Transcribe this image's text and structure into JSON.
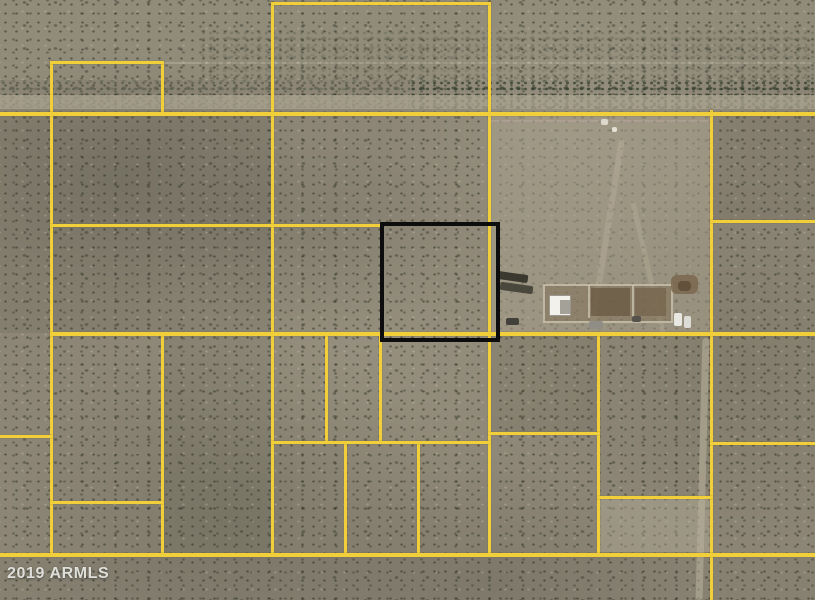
{
  "map": {
    "width": 815,
    "height": 600,
    "watermark": "2019 ARMLS",
    "colors": {
      "boundary_yellow": "#f0cf3a",
      "highlight_black": "#0d0d0d",
      "terrain_base": "#8d8676",
      "road_band": "#aaa28c",
      "yard_light": "#a69f8b",
      "vegetation_dark": "#2f4231"
    },
    "highlight_parcel": {
      "name": "highlighted-parcel-outline",
      "x": 380,
      "y": 222,
      "w": 112,
      "h": 112,
      "stroke": 4
    },
    "boundary_lines": {
      "vertical": [
        {
          "x": 50,
          "y1": 61,
          "y2": 554
        },
        {
          "x": 161,
          "y1": 61,
          "y2": 114
        },
        {
          "x": 161,
          "y1": 332,
          "y2": 554
        },
        {
          "x": 271,
          "y1": 2,
          "y2": 554
        },
        {
          "x": 488,
          "y1": 2,
          "y2": 554
        },
        {
          "x": 325,
          "y1": 332,
          "y2": 443
        },
        {
          "x": 379,
          "y1": 333,
          "y2": 443
        },
        {
          "x": 344,
          "y1": 441,
          "y2": 554
        },
        {
          "x": 417,
          "y1": 441,
          "y2": 554
        },
        {
          "x": 597,
          "y1": 332,
          "y2": 554
        },
        {
          "x": 710,
          "y1": 110,
          "y2": 600
        }
      ],
      "horizontal": [
        {
          "y": 2,
          "x1": 271,
          "x2": 491,
          "t": 3
        },
        {
          "y": 61,
          "x1": 50,
          "x2": 164,
          "t": 3
        },
        {
          "y": 112,
          "x1": 0,
          "x2": 815,
          "t": 4
        },
        {
          "y": 224,
          "x1": 50,
          "x2": 384,
          "t": 3
        },
        {
          "y": 332,
          "x1": 50,
          "x2": 815,
          "t": 4
        },
        {
          "y": 435,
          "x1": 0,
          "x2": 53,
          "t": 3
        },
        {
          "y": 441,
          "x1": 271,
          "x2": 491,
          "t": 3
        },
        {
          "y": 432,
          "x1": 488,
          "x2": 600,
          "t": 3
        },
        {
          "y": 496,
          "x1": 597,
          "x2": 713,
          "t": 3
        },
        {
          "y": 501,
          "x1": 50,
          "x2": 164,
          "t": 3
        },
        {
          "y": 220,
          "x1": 710,
          "x2": 815,
          "t": 3
        },
        {
          "y": 442,
          "x1": 710,
          "x2": 815,
          "t": 3
        },
        {
          "y": 553,
          "x1": 0,
          "x2": 815,
          "t": 4
        }
      ]
    },
    "terrain_underlays": [
      {
        "name": "terrain-top-band",
        "x": 0,
        "y": 0,
        "w": 815,
        "h": 80,
        "fill": "rgba(150,144,126,0.55)"
      },
      {
        "name": "terrain-left-dark",
        "x": 0,
        "y": 114,
        "w": 273,
        "h": 219,
        "fill": "rgba(55,58,45,0.10)"
      },
      {
        "name": "terrain-right-top-dark",
        "x": 710,
        "y": 114,
        "w": 105,
        "h": 107,
        "fill": "rgba(55,58,45,0.09)"
      },
      {
        "name": "terrain-midleft-dark",
        "x": 163,
        "y": 333,
        "w": 110,
        "h": 220,
        "fill": "rgba(55,58,45,0.08)"
      },
      {
        "name": "terrain-bottom-strip",
        "x": 0,
        "y": 554,
        "w": 815,
        "h": 46,
        "fill": "rgba(55,58,45,0.06)"
      },
      {
        "name": "terrain-center-green",
        "x": 489,
        "y": 333,
        "w": 109,
        "h": 99,
        "fill": "rgba(45,60,35,0.09)"
      }
    ],
    "terrain_overlays": [
      {
        "name": "road-band",
        "x": 0,
        "y": 95,
        "w": 815,
        "h": 14,
        "fill": "rgba(172,165,144,0.72)"
      },
      {
        "name": "yard-smooth",
        "x": 490,
        "y": 114,
        "w": 221,
        "h": 219,
        "fill": "rgba(168,161,140,0.52)",
        "radius": 2
      },
      {
        "name": "light-patch-parcel",
        "x": 599,
        "y": 498,
        "w": 112,
        "h": 54,
        "fill": "rgba(181,174,153,0.42)"
      },
      {
        "name": "section-scar-line",
        "x": 163,
        "y": 62,
        "w": 650,
        "h": 2,
        "fill": "rgba(232,227,207,0.22)"
      },
      {
        "name": "yard-scar-line",
        "x": 491,
        "y": 120,
        "w": 219,
        "h": 2,
        "fill": "rgba(210,185,185,0.25)"
      },
      {
        "name": "dirt-track-right",
        "x": 699,
        "y": 338,
        "w": 7,
        "h": 262,
        "fill": "rgba(186,179,156,0.55)",
        "radius": 4,
        "rotate": 1.5
      },
      {
        "name": "dirt-track-yard-1",
        "x": 604,
        "y": 138,
        "w": 6,
        "h": 190,
        "fill": "rgba(192,185,162,0.32)",
        "radius": 3,
        "rotate": 9
      },
      {
        "name": "dirt-track-yard-2",
        "x": 646,
        "y": 200,
        "w": 5,
        "h": 140,
        "fill": "rgba(192,185,162,0.28)",
        "radius": 3,
        "rotate": -13
      }
    ],
    "structures": [
      {
        "name": "corral-fence",
        "x": 543,
        "y": 284,
        "w": 126,
        "h": 35,
        "fill": "rgba(128,110,84,0.50)",
        "border": "2px solid rgba(200,193,172,0.85)"
      },
      {
        "name": "corral-fence-inner1",
        "x": 588,
        "y": 285,
        "w": 2,
        "h": 33,
        "fill": "rgba(200,193,172,0.8)"
      },
      {
        "name": "corral-fence-inner2",
        "x": 632,
        "y": 285,
        "w": 2,
        "h": 33,
        "fill": "rgba(200,193,172,0.8)"
      },
      {
        "name": "corral-dirt-dark-1",
        "x": 591,
        "y": 288,
        "w": 39,
        "h": 28,
        "fill": "rgba(104,88,66,0.75)"
      },
      {
        "name": "corral-dirt-dark-2",
        "x": 635,
        "y": 288,
        "w": 31,
        "h": 28,
        "fill": "rgba(113,96,72,0.65)"
      },
      {
        "name": "white-roof-building",
        "x": 549,
        "y": 295,
        "w": 20,
        "h": 19,
        "fill": "#f2f1ec",
        "border": "1px solid #9a988e"
      },
      {
        "name": "building-shadow",
        "x": 560,
        "y": 300,
        "w": 10,
        "h": 14,
        "fill": "rgba(150,148,138,0.85)"
      },
      {
        "name": "dark-trailer-1",
        "x": 497,
        "y": 273,
        "w": 31,
        "h": 8,
        "fill": "#3a382f",
        "rotate": 8,
        "radius": 2
      },
      {
        "name": "dark-trailer-2",
        "x": 500,
        "y": 284,
        "w": 33,
        "h": 8,
        "fill": "#4a473c",
        "rotate": 8,
        "radius": 2
      },
      {
        "name": "brown-ground-patch",
        "x": 671,
        "y": 275,
        "w": 27,
        "h": 19,
        "fill": "rgba(122,103,78,0.85)",
        "radius": 6
      },
      {
        "name": "brown-patch-core",
        "x": 678,
        "y": 281,
        "w": 13,
        "h": 10,
        "fill": "rgba(95,79,58,0.9)",
        "radius": 4
      },
      {
        "name": "vehicle-dark-1",
        "x": 506,
        "y": 318,
        "w": 13,
        "h": 7,
        "fill": "#42403a",
        "radius": 2
      },
      {
        "name": "vehicle-grey",
        "x": 589,
        "y": 321,
        "w": 14,
        "h": 8,
        "fill": "#8f8d85",
        "radius": 2
      },
      {
        "name": "vehicle-dark-2",
        "x": 632,
        "y": 316,
        "w": 9,
        "h": 6,
        "fill": "#55534b",
        "radius": 2
      },
      {
        "name": "vehicle-white-1",
        "x": 674,
        "y": 313,
        "w": 8,
        "h": 13,
        "fill": "#e8e7e2",
        "radius": 2
      },
      {
        "name": "vehicle-white-2",
        "x": 684,
        "y": 316,
        "w": 7,
        "h": 12,
        "fill": "#dcdbd5",
        "radius": 2
      },
      {
        "name": "white-speck-1",
        "x": 601,
        "y": 119,
        "w": 7,
        "h": 6,
        "fill": "#ddd8cc",
        "radius": 2
      },
      {
        "name": "white-speck-2",
        "x": 612,
        "y": 127,
        "w": 5,
        "h": 5,
        "fill": "#e4e0d5",
        "radius": 2
      }
    ],
    "vegetation_bands": [
      {
        "name": "vegetation-band-left",
        "x": 0,
        "y": 80,
        "w": 410,
        "h": 28,
        "opacity": 0.45
      },
      {
        "name": "vegetation-band-right",
        "x": 410,
        "y": 80,
        "w": 405,
        "h": 29,
        "opacity": 0.85
      },
      {
        "name": "vegetation-scatter-top",
        "x": 200,
        "y": 30,
        "w": 615,
        "h": 50,
        "opacity": 0.25
      }
    ]
  }
}
